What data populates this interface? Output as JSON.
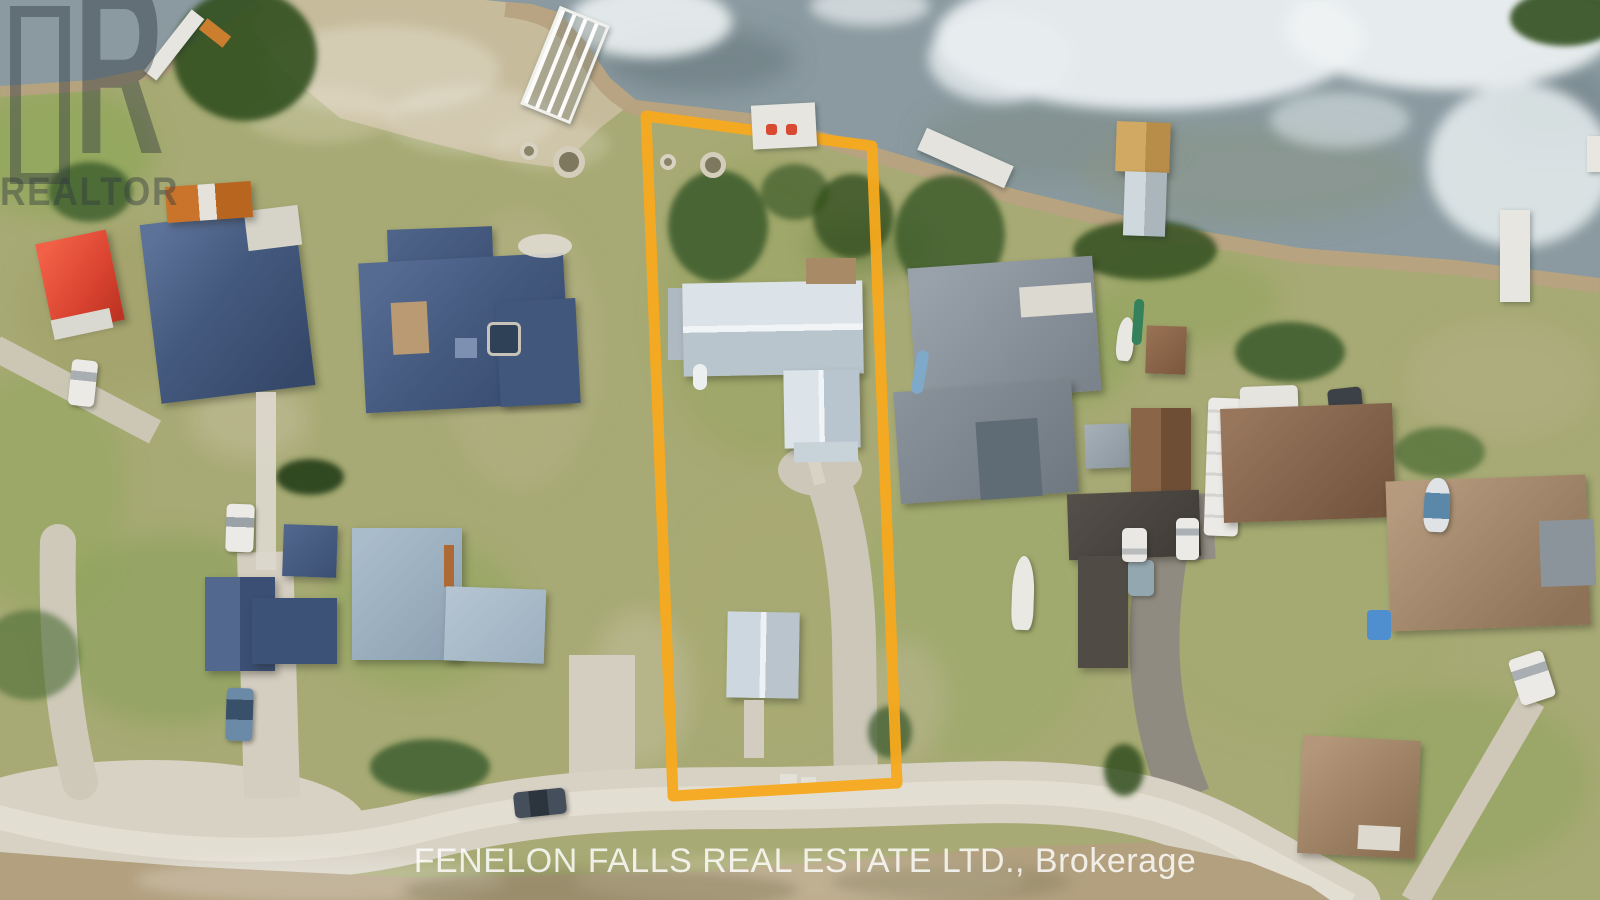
{
  "scene": {
    "type": "aerial-drone-photo",
    "description": "Lakefront residential neighbourhood with one lot highlighted by an orange boundary"
  },
  "watermarks": {
    "logo_letter": "R",
    "logo_text": "REALTOR",
    "brokerage_text": "FENELON FALLS REAL ESTATE LTD., Brokerage"
  },
  "colors": {
    "property_outline": "#F6A91E",
    "water": "#8A9AA0",
    "ice": "#E9EFF0",
    "grass": "#A7AA74",
    "shore": "#B7A281",
    "road": "#D8D2C5",
    "navy_roof": "#44597C",
    "red_roof": "#E0492F",
    "gray_roof": "#8A939B",
    "white_roof": "#D3DCE2",
    "brown_roof": "#8A6950",
    "tan_roof": "#A98E73"
  }
}
